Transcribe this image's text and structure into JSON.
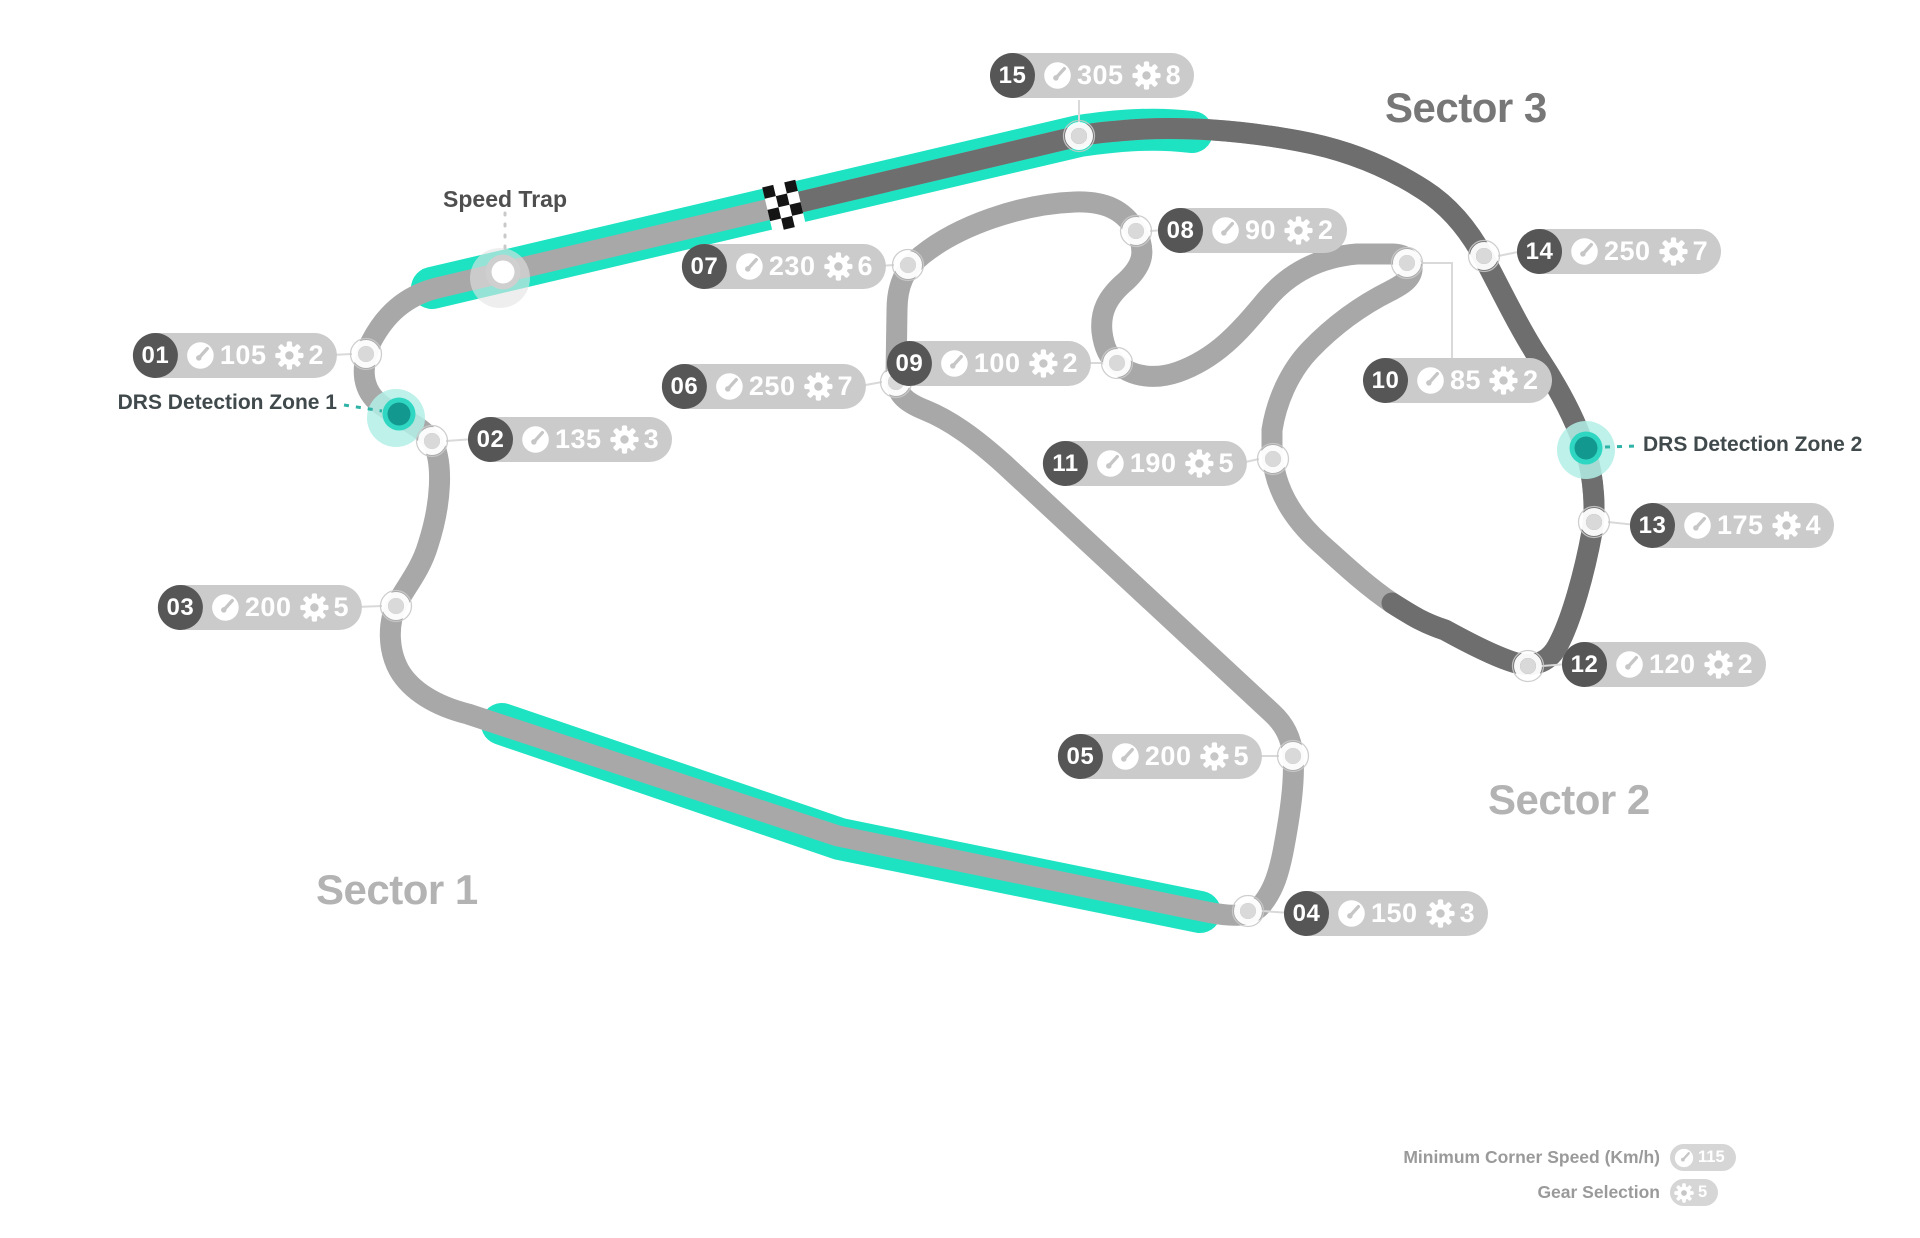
{
  "map": {
    "sectors": [
      {
        "label": "Sector 1",
        "tone": "light",
        "x": 316,
        "y": 866
      },
      {
        "label": "Sector 2",
        "tone": "light",
        "x": 1488,
        "y": 776
      },
      {
        "label": "Sector 3",
        "tone": "dark",
        "x": 1385,
        "y": 84
      }
    ],
    "speed_trap": {
      "label": "Speed Trap",
      "circle": [
        503,
        272
      ]
    },
    "drs_zones": [
      {
        "label": "DRS Detection Zone 1",
        "dot": [
          399,
          414
        ]
      },
      {
        "label": "DRS Detection Zone 2",
        "dot": [
          1586,
          448
        ]
      }
    ],
    "corners": [
      {
        "num": "01",
        "speed": "105",
        "gear": "2",
        "marker": [
          366,
          354
        ],
        "label": [
          337,
          355
        ],
        "align": "right"
      },
      {
        "num": "02",
        "speed": "135",
        "gear": "3",
        "marker": [
          432,
          441
        ],
        "label": [
          468,
          439
        ],
        "align": "left"
      },
      {
        "num": "03",
        "speed": "200",
        "gear": "5",
        "marker": [
          396,
          606
        ],
        "label": [
          362,
          607
        ],
        "align": "right"
      },
      {
        "num": "04",
        "speed": "150",
        "gear": "3",
        "marker": [
          1248,
          911
        ],
        "label": [
          1284,
          913
        ],
        "align": "left"
      },
      {
        "num": "05",
        "speed": "200",
        "gear": "5",
        "marker": [
          1293,
          756
        ],
        "label": [
          1262,
          756
        ],
        "align": "right"
      },
      {
        "num": "06",
        "speed": "250",
        "gear": "7",
        "marker": [
          896,
          382
        ],
        "label": [
          866,
          386
        ],
        "align": "right"
      },
      {
        "num": "07",
        "speed": "230",
        "gear": "6",
        "marker": [
          908,
          265
        ],
        "label": [
          886,
          266
        ],
        "align": "right"
      },
      {
        "num": "08",
        "speed": "90",
        "gear": "2",
        "marker": [
          1136,
          231
        ],
        "label": [
          1158,
          230
        ],
        "align": "left"
      },
      {
        "num": "09",
        "speed": "100",
        "gear": "2",
        "marker": [
          1117,
          363
        ],
        "label": [
          1091,
          363
        ],
        "align": "right"
      },
      {
        "num": "10",
        "speed": "85",
        "gear": "2",
        "marker": [
          1407,
          263
        ],
        "label": [
          1363,
          380
        ],
        "align": "left",
        "connector": [
          [
            1420,
            263
          ],
          [
            1452,
            263
          ],
          [
            1452,
            358
          ]
        ]
      },
      {
        "num": "11",
        "speed": "190",
        "gear": "5",
        "marker": [
          1273,
          459
        ],
        "label": [
          1247,
          463
        ],
        "align": "right"
      },
      {
        "num": "12",
        "speed": "120",
        "gear": "2",
        "marker": [
          1528,
          666
        ],
        "label": [
          1562,
          664
        ],
        "align": "left"
      },
      {
        "num": "13",
        "speed": "175",
        "gear": "4",
        "marker": [
          1594,
          522
        ],
        "label": [
          1630,
          525
        ],
        "align": "left"
      },
      {
        "num": "14",
        "speed": "250",
        "gear": "7",
        "marker": [
          1484,
          256
        ],
        "label": [
          1517,
          251
        ],
        "align": "left"
      },
      {
        "num": "15",
        "speed": "305",
        "gear": "8",
        "marker": [
          1079,
          136
        ],
        "label": [
          990,
          75
        ],
        "align": "left",
        "connector": [
          [
            1079,
            100
          ],
          [
            1079,
            123
          ]
        ]
      }
    ],
    "legend": {
      "rows": [
        {
          "label": "Minimum Corner Speed (Km/h)",
          "icon": "speedometer",
          "value": "115"
        },
        {
          "label": "Gear Selection",
          "icon": "gear",
          "value": "5"
        }
      ]
    },
    "colors": {
      "drs_highlight": "#1EE3C2",
      "drs_dot": "#12988E",
      "track": "#A8A8A8",
      "sector3_track": "#6E6E6E",
      "pill_bg": "#CBCBCB",
      "corner_number_bg": "#565656"
    }
  }
}
